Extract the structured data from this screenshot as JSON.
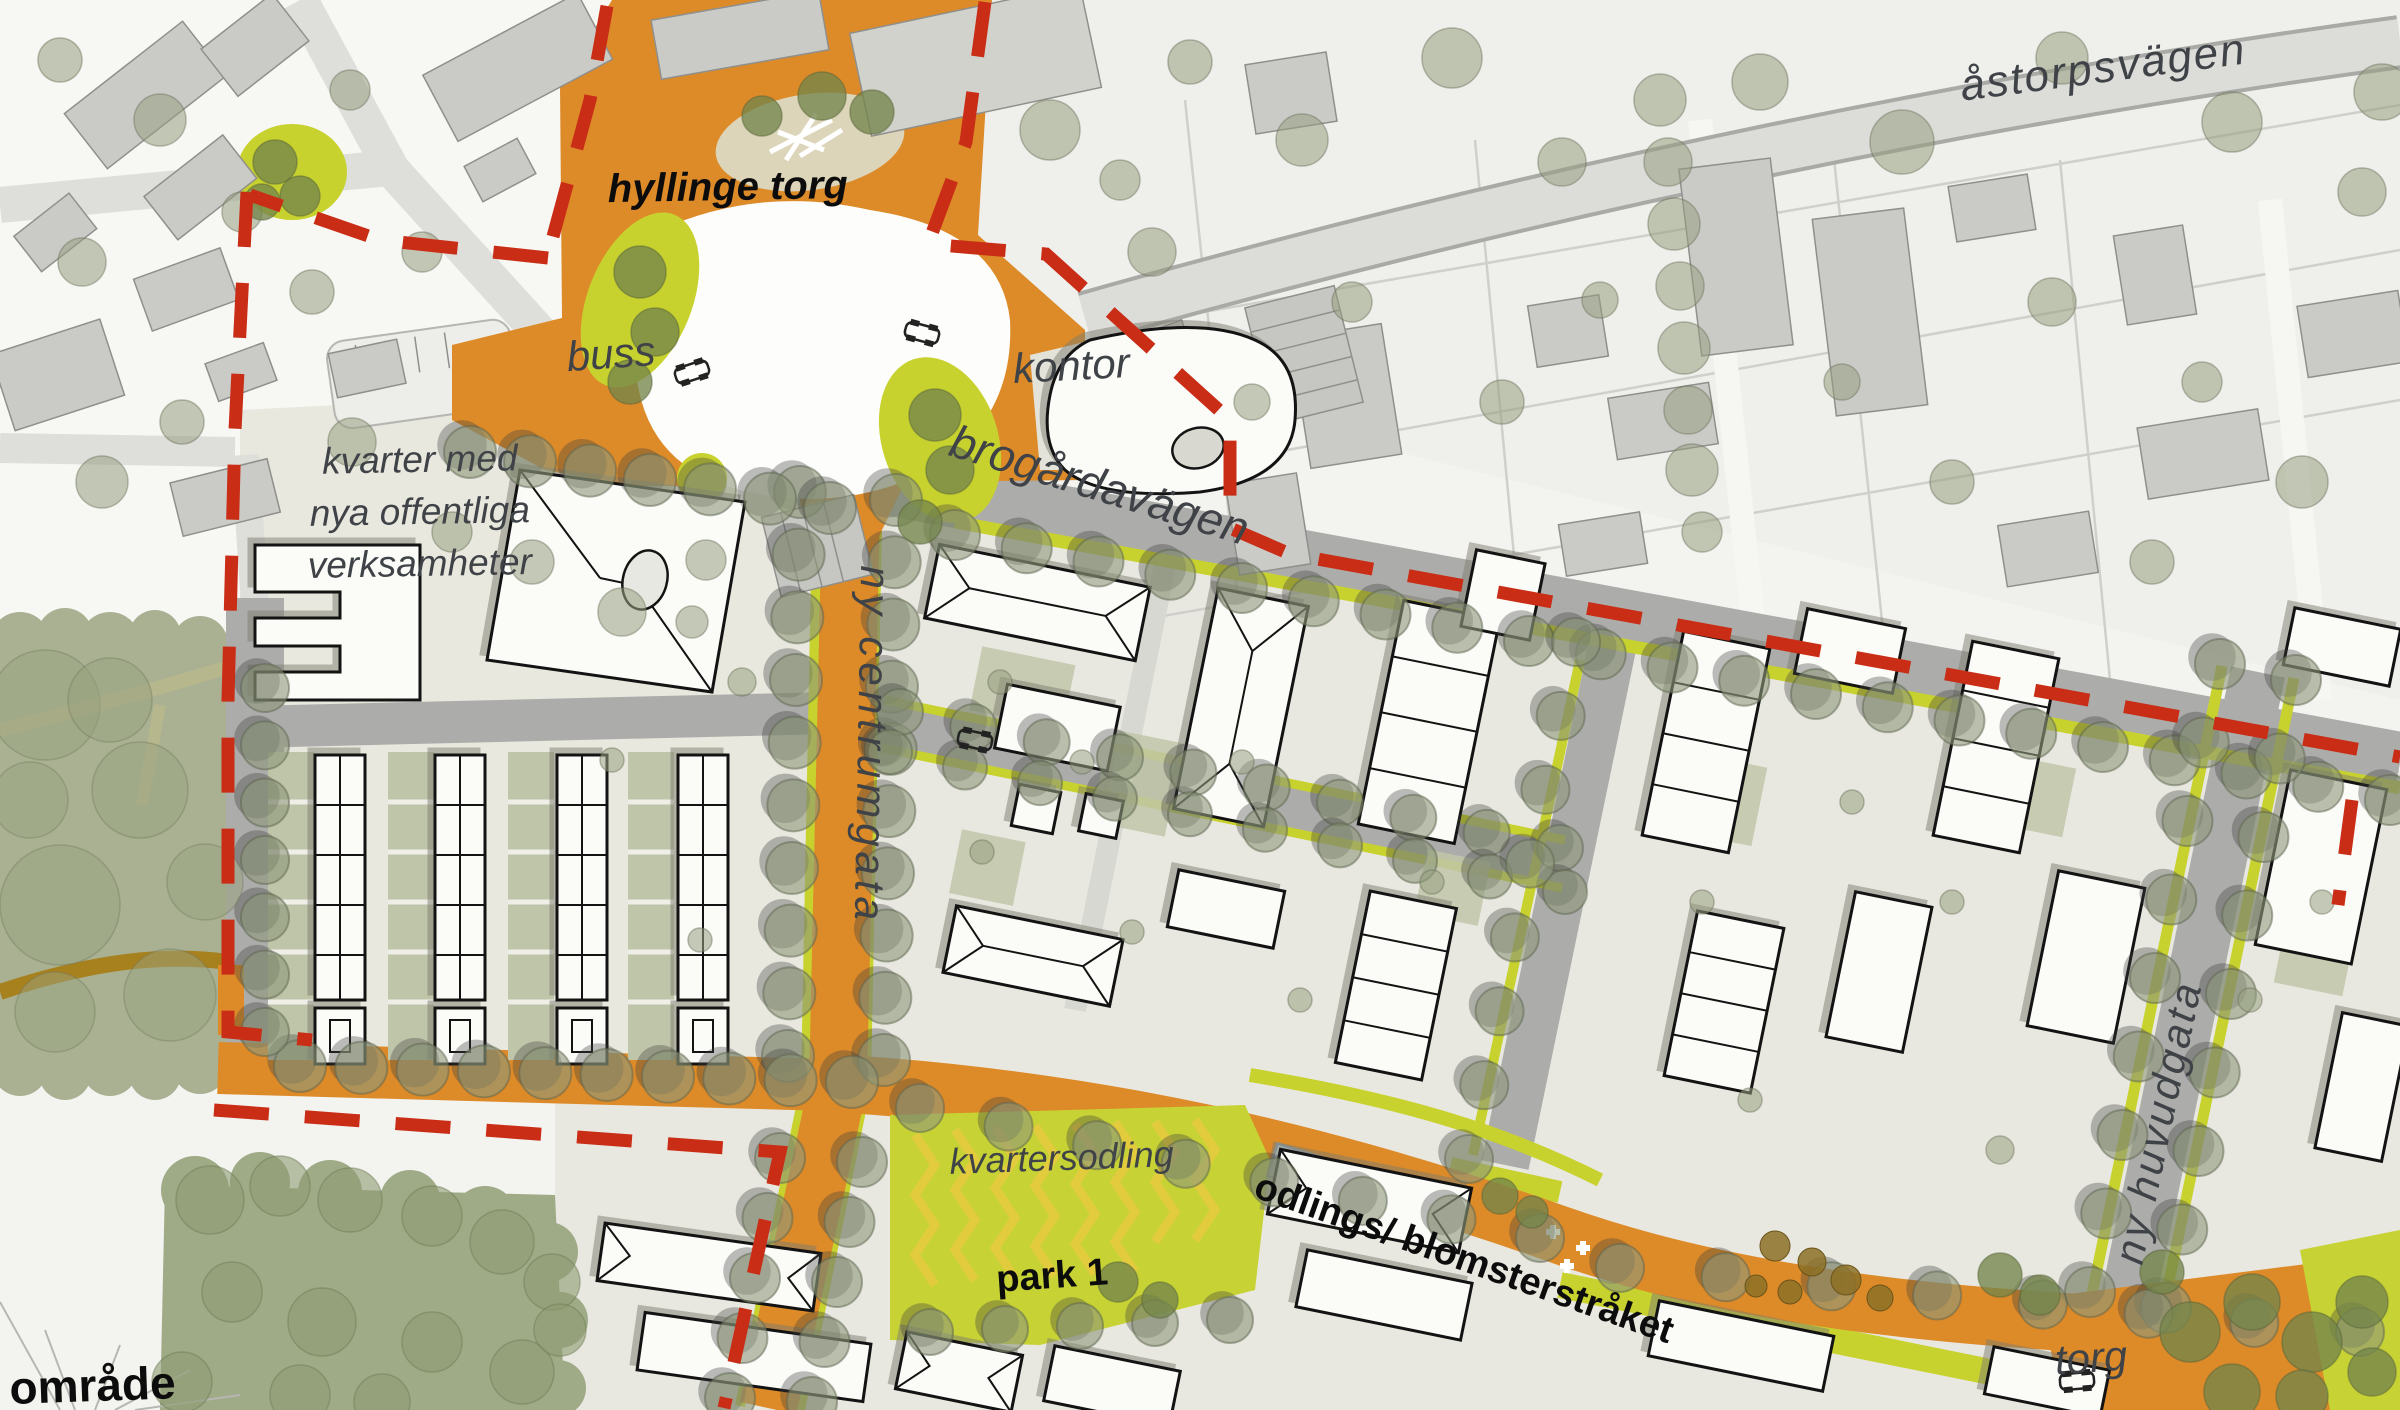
{
  "meta": {
    "map_type": "urban development illustration plan",
    "place": "Hyllinge"
  },
  "labels": {
    "astorpsvagen": "åstorpsvägen",
    "hyllinge_torg": "hyllinge torg",
    "buss": "buss",
    "kontor": "kontor",
    "brogardavagen": "brogårdavägen",
    "kvarter_line1": "kvarter med",
    "kvarter_line2": "nya offentliga",
    "kvarter_line3": "verksamheter",
    "ny_centrumgata": "ny centrumgata",
    "kvartersodling": "kvartersodling",
    "odlings_blomsterstraket": "odlings/ blomsterstråket",
    "park_1": "park 1",
    "ny_huvudgata": "ny huvudgata",
    "torg": "torg",
    "omrade_partial": "område"
  },
  "colors": {
    "background": "#F3F3F0",
    "orange_street": "#DD8A28",
    "boundary_red": "#C92D16",
    "chartreuse_green": "#C8D22F",
    "sage_nature": "#A9B192",
    "tree_olive": "#8E987A",
    "existing_building": "#CACAC7",
    "new_building": "#FBFBF8",
    "road_gray": "#ACACAA",
    "label_gray": "#3F4347",
    "label_black": "#0C0C0C",
    "water_blue": "#CBD8DE",
    "path_brown": "#A8811F"
  },
  "map_geometry": {
    "tree_rows": [
      [
        800,
        492,
        788,
        1056,
        10,
        26
      ],
      [
        896,
        500,
        884,
        1060,
        10,
        26
      ],
      [
        780,
        1158,
        730,
        1398,
        5,
        25
      ],
      [
        862,
        1162,
        812,
        1402,
        5,
        25
      ],
      [
        300,
        1066,
        852,
        1082,
        10,
        26
      ],
      [
        265,
        688,
        265,
        1032,
        7,
        24
      ],
      [
        470,
        452,
        830,
        508,
        7,
        26
      ],
      [
        955,
        535,
        2390,
        800,
        21,
        25
      ],
      [
        900,
        712,
        1560,
        848,
        10,
        23
      ],
      [
        890,
        752,
        1565,
        892,
        10,
        22
      ],
      [
        1576,
        642,
        1469,
        1159,
        8,
        24
      ],
      [
        2220,
        664,
        2090,
        1292,
        9,
        25
      ],
      [
        2296,
        680,
        2166,
        1308,
        9,
        25
      ],
      [
        920,
        1108,
        1540,
        1238,
        8,
        24
      ],
      [
        1620,
        1268,
        2360,
        1332,
        8,
        24
      ],
      [
        930,
        1332,
        1230,
        1320,
        5,
        23
      ]
    ],
    "trees": [
      [
        1050,
        130,
        30,
        "f"
      ],
      [
        1190,
        62,
        22,
        "f"
      ],
      [
        1302,
        140,
        26,
        "f"
      ],
      [
        1452,
        58,
        30,
        "f"
      ],
      [
        1562,
        162,
        24,
        "f"
      ],
      [
        1760,
        82,
        28,
        "f"
      ],
      [
        1902,
        142,
        32,
        "f"
      ],
      [
        2062,
        58,
        26,
        "f"
      ],
      [
        2232,
        122,
        30,
        "f"
      ],
      [
        2362,
        192,
        24,
        "f"
      ],
      [
        1352,
        302,
        20,
        "f"
      ],
      [
        1502,
        402,
        22,
        "f"
      ],
      [
        2052,
        302,
        24,
        "f"
      ],
      [
        2202,
        382,
        20,
        "f"
      ],
      [
        1952,
        482,
        22,
        "f"
      ],
      [
        2302,
        482,
        26,
        "f"
      ],
      [
        1152,
        252,
        24,
        "f"
      ],
      [
        1252,
        402,
        18,
        "f"
      ],
      [
        2382,
        92,
        28,
        "f"
      ],
      [
        1842,
        382,
        18,
        "f"
      ],
      [
        1702,
        532,
        20,
        "f"
      ],
      [
        2152,
        562,
        22,
        "f"
      ],
      [
        1120,
        180,
        20,
        "f"
      ],
      [
        1600,
        300,
        18,
        "f"
      ],
      [
        1660,
        100,
        26,
        "f"
      ],
      [
        1668,
        162,
        24,
        "f"
      ],
      [
        1674,
        224,
        26,
        "f"
      ],
      [
        1680,
        286,
        24,
        "f"
      ],
      [
        1684,
        348,
        26,
        "f"
      ],
      [
        1688,
        410,
        24,
        "f"
      ],
      [
        1692,
        470,
        26,
        "f"
      ],
      [
        160,
        120,
        26,
        "f"
      ],
      [
        242,
        212,
        20,
        "f"
      ],
      [
        82,
        262,
        24,
        "f"
      ],
      [
        312,
        292,
        22,
        "f"
      ],
      [
        422,
        252,
        20,
        "f"
      ],
      [
        182,
        422,
        22,
        "f"
      ],
      [
        352,
        442,
        24,
        "f"
      ],
      [
        102,
        482,
        26,
        "f"
      ],
      [
        452,
        532,
        20,
        "f"
      ],
      [
        532,
        562,
        22,
        "f"
      ],
      [
        622,
        612,
        24,
        "f"
      ],
      [
        706,
        560,
        20,
        "f"
      ],
      [
        60,
        60,
        22,
        "f"
      ],
      [
        350,
        90,
        20,
        "f"
      ],
      [
        1000,
        682,
        12,
        "f"
      ],
      [
        1082,
        762,
        12,
        "f"
      ],
      [
        1242,
        762,
        12,
        "f"
      ],
      [
        1432,
        882,
        12,
        "f"
      ],
      [
        982,
        852,
        12,
        "f"
      ],
      [
        1132,
        932,
        12,
        "f"
      ],
      [
        1702,
        902,
        12,
        "f"
      ],
      [
        1852,
        802,
        12,
        "f"
      ],
      [
        1952,
        902,
        12,
        "f"
      ],
      [
        2322,
        902,
        12,
        "f"
      ],
      [
        692,
        622,
        16,
        "f"
      ],
      [
        742,
        682,
        14,
        "f"
      ],
      [
        612,
        760,
        12,
        "f"
      ],
      [
        700,
        940,
        12,
        "f"
      ],
      [
        1300,
        1000,
        12,
        "f"
      ],
      [
        1750,
        1100,
        12,
        "f"
      ],
      [
        2000,
        1150,
        14,
        "f"
      ],
      [
        2250,
        1000,
        12,
        "f"
      ],
      [
        45,
        705,
        55,
        "n"
      ],
      [
        140,
        790,
        48,
        "n"
      ],
      [
        60,
        905,
        60,
        "n"
      ],
      [
        170,
        995,
        46,
        "n"
      ],
      [
        55,
        1012,
        40,
        "n"
      ],
      [
        205,
        882,
        38,
        "n"
      ],
      [
        110,
        700,
        42,
        "n"
      ],
      [
        30,
        800,
        38,
        "n"
      ],
      [
        640,
        272,
        26,
        "d"
      ],
      [
        655,
        332,
        24,
        "d"
      ],
      [
        630,
        382,
        22,
        "d"
      ],
      [
        935,
        415,
        26,
        "d"
      ],
      [
        950,
        470,
        24,
        "d"
      ],
      [
        920,
        522,
        22,
        "d"
      ],
      [
        822,
        96,
        24,
        "d"
      ],
      [
        872,
        112,
        22,
        "d"
      ],
      [
        762,
        116,
        20,
        "d"
      ],
      [
        2190,
        1332,
        30,
        "d"
      ],
      [
        2252,
        1302,
        28,
        "d"
      ],
      [
        2312,
        1342,
        30,
        "d"
      ],
      [
        2362,
        1302,
        26,
        "d"
      ],
      [
        2232,
        1392,
        28,
        "d"
      ],
      [
        2302,
        1396,
        26,
        "d"
      ],
      [
        2372,
        1372,
        24,
        "d"
      ],
      [
        2162,
        1272,
        22,
        "d"
      ],
      [
        275,
        162,
        22,
        "d"
      ],
      [
        300,
        196,
        20,
        "d"
      ],
      [
        262,
        202,
        18,
        "d"
      ],
      [
        1500,
        1196,
        18,
        "d"
      ],
      [
        1532,
        1212,
        16,
        "d"
      ],
      [
        1118,
        1282,
        20,
        "d"
      ],
      [
        1160,
        1300,
        18,
        "d"
      ],
      [
        2000,
        1275,
        22,
        "d"
      ],
      [
        2040,
        1295,
        20,
        "d"
      ],
      [
        210,
        1200,
        34,
        "b"
      ],
      [
        280,
        1186,
        30,
        "b"
      ],
      [
        350,
        1200,
        32,
        "b"
      ],
      [
        432,
        1216,
        30,
        "b"
      ],
      [
        502,
        1242,
        32,
        "b"
      ],
      [
        552,
        1282,
        28,
        "b"
      ],
      [
        232,
        1292,
        30,
        "b"
      ],
      [
        322,
        1322,
        34,
        "b"
      ],
      [
        432,
        1342,
        30,
        "b"
      ],
      [
        522,
        1372,
        32,
        "b"
      ],
      [
        182,
        1382,
        30,
        "b"
      ],
      [
        382,
        1402,
        28,
        "b"
      ],
      [
        560,
        1330,
        26,
        "b"
      ],
      [
        300,
        1395,
        30,
        "b"
      ],
      [
        1775,
        1246,
        15,
        "br"
      ],
      [
        1812,
        1262,
        14,
        "br"
      ],
      [
        1846,
        1280,
        15,
        "br"
      ],
      [
        1880,
        1298,
        13,
        "br"
      ],
      [
        1790,
        1292,
        12,
        "br"
      ],
      [
        1756,
        1286,
        11,
        "br"
      ]
    ]
  }
}
